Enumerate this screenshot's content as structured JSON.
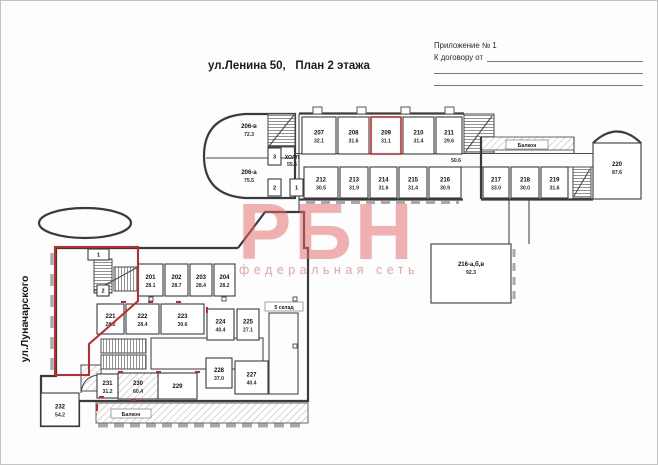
{
  "header": {
    "title": "ул.Ленина 50,   План 2 этажа",
    "annex_line1": "Приложение № 1",
    "annex_label": "К договору от",
    "street_label": "ул.Луначарского"
  },
  "watermark": {
    "logo": "РБН",
    "tagline": "федеральная сеть"
  },
  "theme": {
    "highlight": "#c62828",
    "wall": "#3b3b3b",
    "watermark_logo": "#e76b6b",
    "watermark_tagline": "#e9a0a0"
  },
  "plan": {
    "labels": {
      "hall": "ХОЛЛ",
      "hall_area": "55.6",
      "balcony_top": "Балкон",
      "balcony_bottom": "Балкон",
      "warehouse": "5 склад",
      "corridor_area": "50.6"
    },
    "rooms": [
      {
        "id": "206-в",
        "area": "72.3",
        "x": 214,
        "y": 116,
        "w": 80,
        "h": 41,
        "norect": true,
        "lx": 248,
        "ly": 128
      },
      {
        "id": "206-а",
        "area": "75.5",
        "x": 214,
        "y": 157,
        "w": 80,
        "h": 40,
        "norect": true,
        "lx": 248,
        "ly": 174
      },
      {
        "id": "207",
        "area": "32.1",
        "x": 301,
        "y": 116,
        "w": 34,
        "h": 37
      },
      {
        "id": "208",
        "area": "31.6",
        "x": 337,
        "y": 116,
        "w": 31,
        "h": 37
      },
      {
        "id": "209",
        "area": "31.1",
        "x": 370,
        "y": 116,
        "w": 30,
        "h": 37,
        "highlight": true
      },
      {
        "id": "210",
        "area": "31.4",
        "x": 402,
        "y": 116,
        "w": 31,
        "h": 37
      },
      {
        "id": "211",
        "area": "29.6",
        "x": 435,
        "y": 116,
        "w": 26,
        "h": 37
      },
      {
        "id": "3",
        "x": 267,
        "y": 147,
        "w": 13,
        "h": 17,
        "small": true
      },
      {
        "id": "2",
        "x": 267,
        "y": 178,
        "w": 13,
        "h": 17,
        "small": true
      },
      {
        "id": "1",
        "x": 289,
        "y": 178,
        "w": 13,
        "h": 17,
        "small": true
      },
      {
        "id": "212",
        "area": "30.5",
        "x": 303,
        "y": 166,
        "w": 34,
        "h": 31
      },
      {
        "id": "213",
        "area": "31.9",
        "x": 339,
        "y": 166,
        "w": 28,
        "h": 31
      },
      {
        "id": "214",
        "area": "31.6",
        "x": 369,
        "y": 166,
        "w": 27,
        "h": 31
      },
      {
        "id": "215",
        "area": "31.4",
        "x": 398,
        "y": 166,
        "w": 28,
        "h": 31
      },
      {
        "id": "216",
        "area": "30.9",
        "x": 428,
        "y": 166,
        "w": 32,
        "h": 31
      },
      {
        "id": "217",
        "area": "33.0",
        "x": 482,
        "y": 166,
        "w": 26,
        "h": 31
      },
      {
        "id": "218",
        "area": "30.0",
        "x": 510,
        "y": 166,
        "w": 28,
        "h": 31
      },
      {
        "id": "219",
        "area": "31.6",
        "x": 540,
        "y": 166,
        "w": 27,
        "h": 31
      },
      {
        "id": "220",
        "area": "87.6",
        "x": 592,
        "y": 142,
        "w": 48,
        "h": 56,
        "ly": 166
      },
      {
        "id": "216-а,б,в",
        "area": "92.3",
        "x": 430,
        "y": 243,
        "w": 80,
        "h": 59,
        "ly": 266
      },
      {
        "id": "201",
        "area": "28.1",
        "x": 137,
        "y": 263,
        "w": 25,
        "h": 32
      },
      {
        "id": "202",
        "area": "28.7",
        "x": 164,
        "y": 263,
        "w": 23,
        "h": 32
      },
      {
        "id": "203",
        "area": "28.4",
        "x": 189,
        "y": 263,
        "w": 22,
        "h": 32
      },
      {
        "id": "204",
        "area": "28.2",
        "x": 213,
        "y": 263,
        "w": 21,
        "h": 32
      },
      {
        "id": "1",
        "x": 87,
        "y": 248,
        "w": 21,
        "h": 11,
        "small": true
      },
      {
        "id": "2",
        "x": 96,
        "y": 284,
        "w": 12,
        "h": 11,
        "small": true
      },
      {
        "id": "221",
        "area": "28.2",
        "x": 96,
        "y": 303,
        "w": 27,
        "h": 30
      },
      {
        "id": "222",
        "area": "28.4",
        "x": 125,
        "y": 303,
        "w": 33,
        "h": 30
      },
      {
        "id": "223",
        "area": "30.6",
        "x": 160,
        "y": 303,
        "w": 43,
        "h": 30
      },
      {
        "id": "224",
        "area": "40.4",
        "x": 206,
        "y": 308,
        "w": 27,
        "h": 31
      },
      {
        "id": "225",
        "area": "27.1",
        "x": 236,
        "y": 308,
        "w": 22,
        "h": 31
      },
      {
        "id": "228",
        "area": "37.0",
        "x": 205,
        "y": 357,
        "w": 26,
        "h": 30
      },
      {
        "id": "227",
        "area": "40.4",
        "x": 234,
        "y": 360,
        "w": 33,
        "h": 33
      },
      {
        "id": "229",
        "x": 157,
        "y": 372,
        "w": 39,
        "h": 26
      },
      {
        "id": "230",
        "area": "60.4",
        "x": 117,
        "y": 372,
        "w": 40,
        "h": 26,
        "hatched": true
      },
      {
        "id": "231",
        "area": "31.2",
        "x": 96,
        "y": 373,
        "w": 21,
        "h": 24
      },
      {
        "id": "232",
        "area": "54.2",
        "x": 40,
        "y": 392,
        "w": 38,
        "h": 33
      }
    ]
  }
}
